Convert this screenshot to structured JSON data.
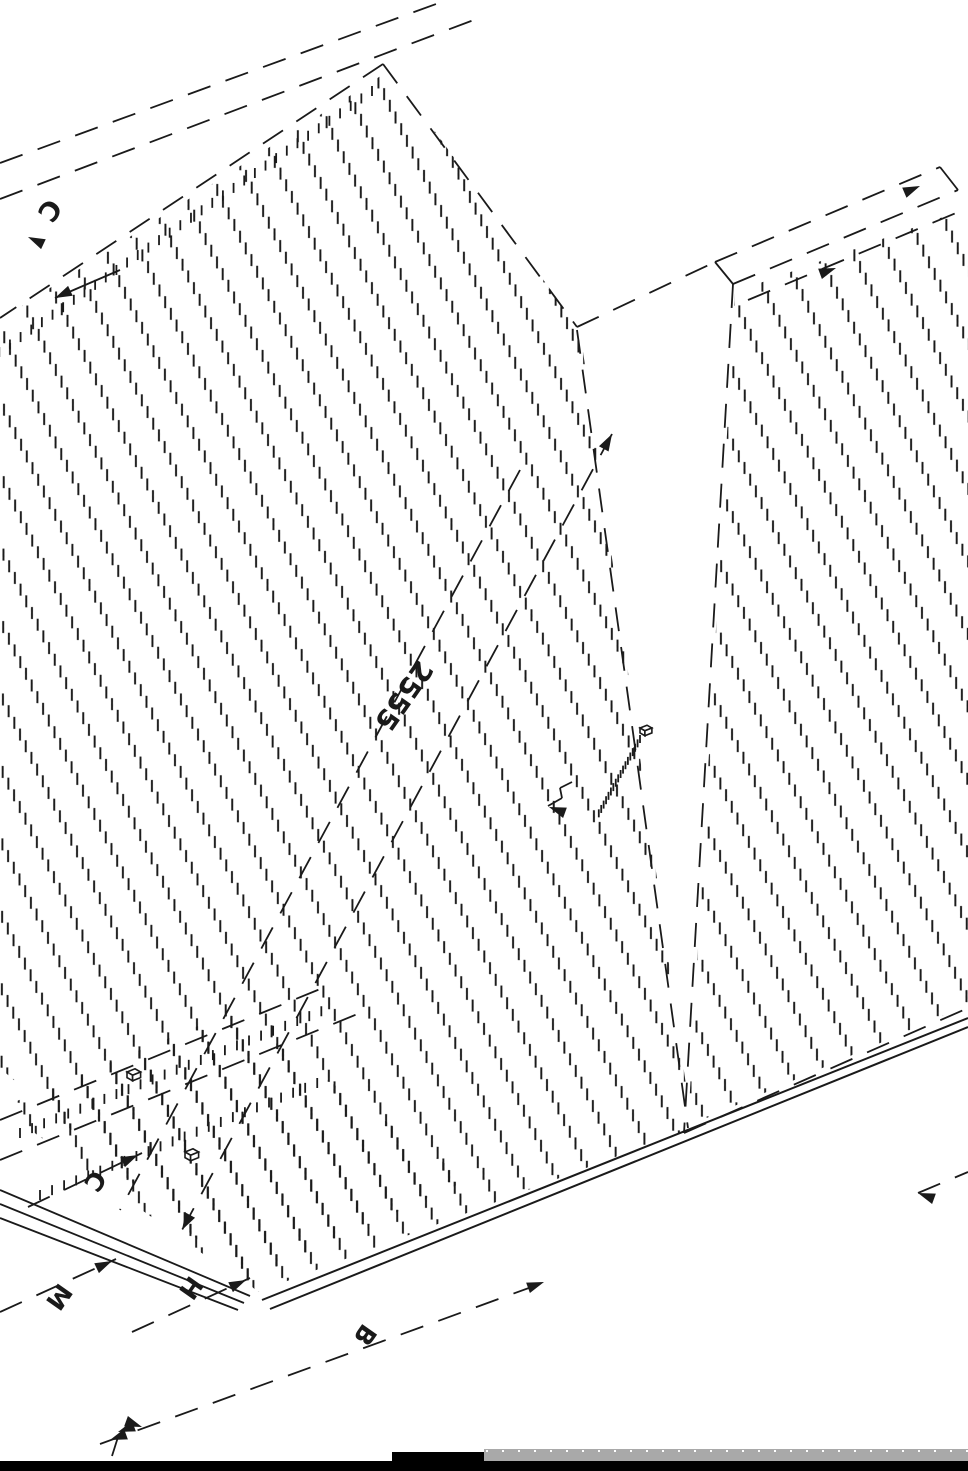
{
  "drawing": {
    "title": "isometric-panel-drawing",
    "labels": {
      "top_width": "C",
      "main_length": "2555",
      "offset_c": "C",
      "margin_m": "M",
      "height_h": "H",
      "base_b": "B"
    },
    "colors": {
      "ink": "#1a1a1a",
      "paper": "#ffffff",
      "scrollbar": "#a9a9a9",
      "window_bar": "#000000"
    }
  }
}
